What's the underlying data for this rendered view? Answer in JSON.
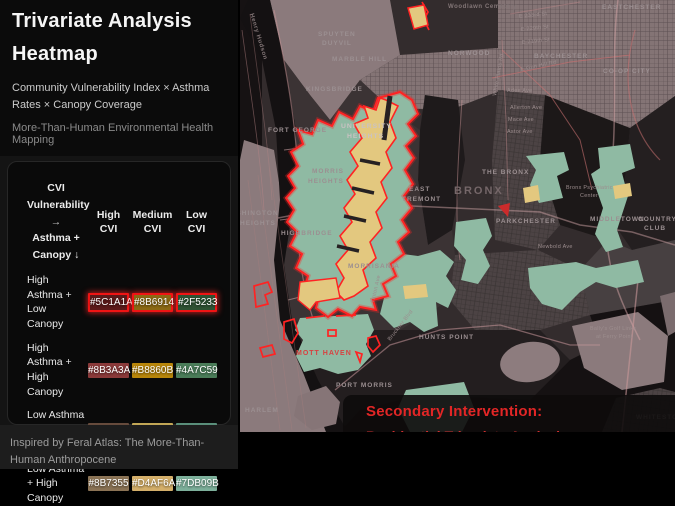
{
  "sidebar": {
    "title": "Trivariate Analysis Heatmap",
    "subtitle": "Community Vulnerability Index × Asthma Rates × Canopy Coverage",
    "tagline": "More-Than-Human Environmental Health Mapping",
    "footer": "Inspired by Feral Atlas: The More-Than-Human Anthropocene",
    "legend": {
      "corner": [
        "CVI Vulnerability",
        "→",
        "Asthma + Canopy ↓"
      ],
      "columns": [
        "High CVI",
        "Medium CVI",
        "Low CVI"
      ],
      "rows": [
        {
          "label": "High Asthma + Low Canopy",
          "cells": [
            "#5C1A1A",
            "#8B6914",
            "#2F5233"
          ]
        },
        {
          "label": "High Asthma + High Canopy",
          "cells": [
            "#8B3A3A",
            "#B8860B",
            "#4A7C59"
          ]
        },
        {
          "label": "Low Asthma + Low Canopy",
          "cells": [
            "#664B3C",
            "#C2A756",
            "#5A8F7B"
          ]
        },
        {
          "label": "Low Asthma + High Canopy",
          "cells": [
            "#8B7355",
            "#D4AF6A",
            "#7DB09B"
          ]
        }
      ]
    }
  },
  "colors": {
    "highlight_border": "#F01414",
    "callout_text": "#E22626",
    "zone_teal": "#8FBAA3",
    "zone_khaki": "#E3C87F",
    "zone_outline": "#FF2323"
  },
  "map": {
    "callout": {
      "title": "Secondary Intervention:",
      "line2": "Residential Trivariate Analysis"
    },
    "labels": {
      "henry_hudson": "Henry Hudson",
      "spuyten1": "SPUYTEN",
      "spuyten2": "DUYVIL",
      "marble_hill": "MARBLE HILL",
      "kingsbridge": "KINGSBRIDGE",
      "fort_george": "FORT GEORGE",
      "woodlawn": "Woodlawn Cemetery",
      "norwood": "NORWOOD",
      "eastchester": "EASTCHESTER",
      "baychester": "BAYCHESTER",
      "coop_city": "CO-OP CITY",
      "e233": "E 233rd St",
      "e229": "E 229th St",
      "e219": "E 219th St",
      "gun_hill": "E Gun Hill Rd",
      "white_plains": "White Plains Rd",
      "adee": "Adee Ave",
      "allerton": "Allerton Ave",
      "mace": "Mace Ave",
      "astor": "Astor Ave",
      "university1": "UNIVERSITY",
      "university2": "HEIGHTS",
      "morris1": "MORRIS",
      "morris2": "HEIGHTS",
      "washington1": "WASHINGTON",
      "washington2": "HEIGHTS",
      "highbridge": "HIGHBRIDGE",
      "tremont1": "EAST",
      "tremont2": "TREMONT",
      "the_bronx": "THE BRONX",
      "bronx_big": "BRONX",
      "psych1": "Bronx Psychiatric",
      "psych2": "Center",
      "parkchester": "PARKCHESTER",
      "middletown": "MIDDLETOWN",
      "country1": "COUNTRY",
      "country2": "CLUB",
      "newbold": "Newbold Ave",
      "morrisania": "MORRISANIA",
      "hunts_point": "HUNTS POINT",
      "bruckner": "Bruckner Blvd",
      "tinton": "Tinton Ave",
      "mott_haven": "MOTT HAVEN",
      "port_morris": "PORT MORRIS",
      "harlem": "HARLEM",
      "golf1": "Bally's Golf Links",
      "golf2": "at Ferry Point",
      "whitestone": "WHITESTONE"
    }
  }
}
